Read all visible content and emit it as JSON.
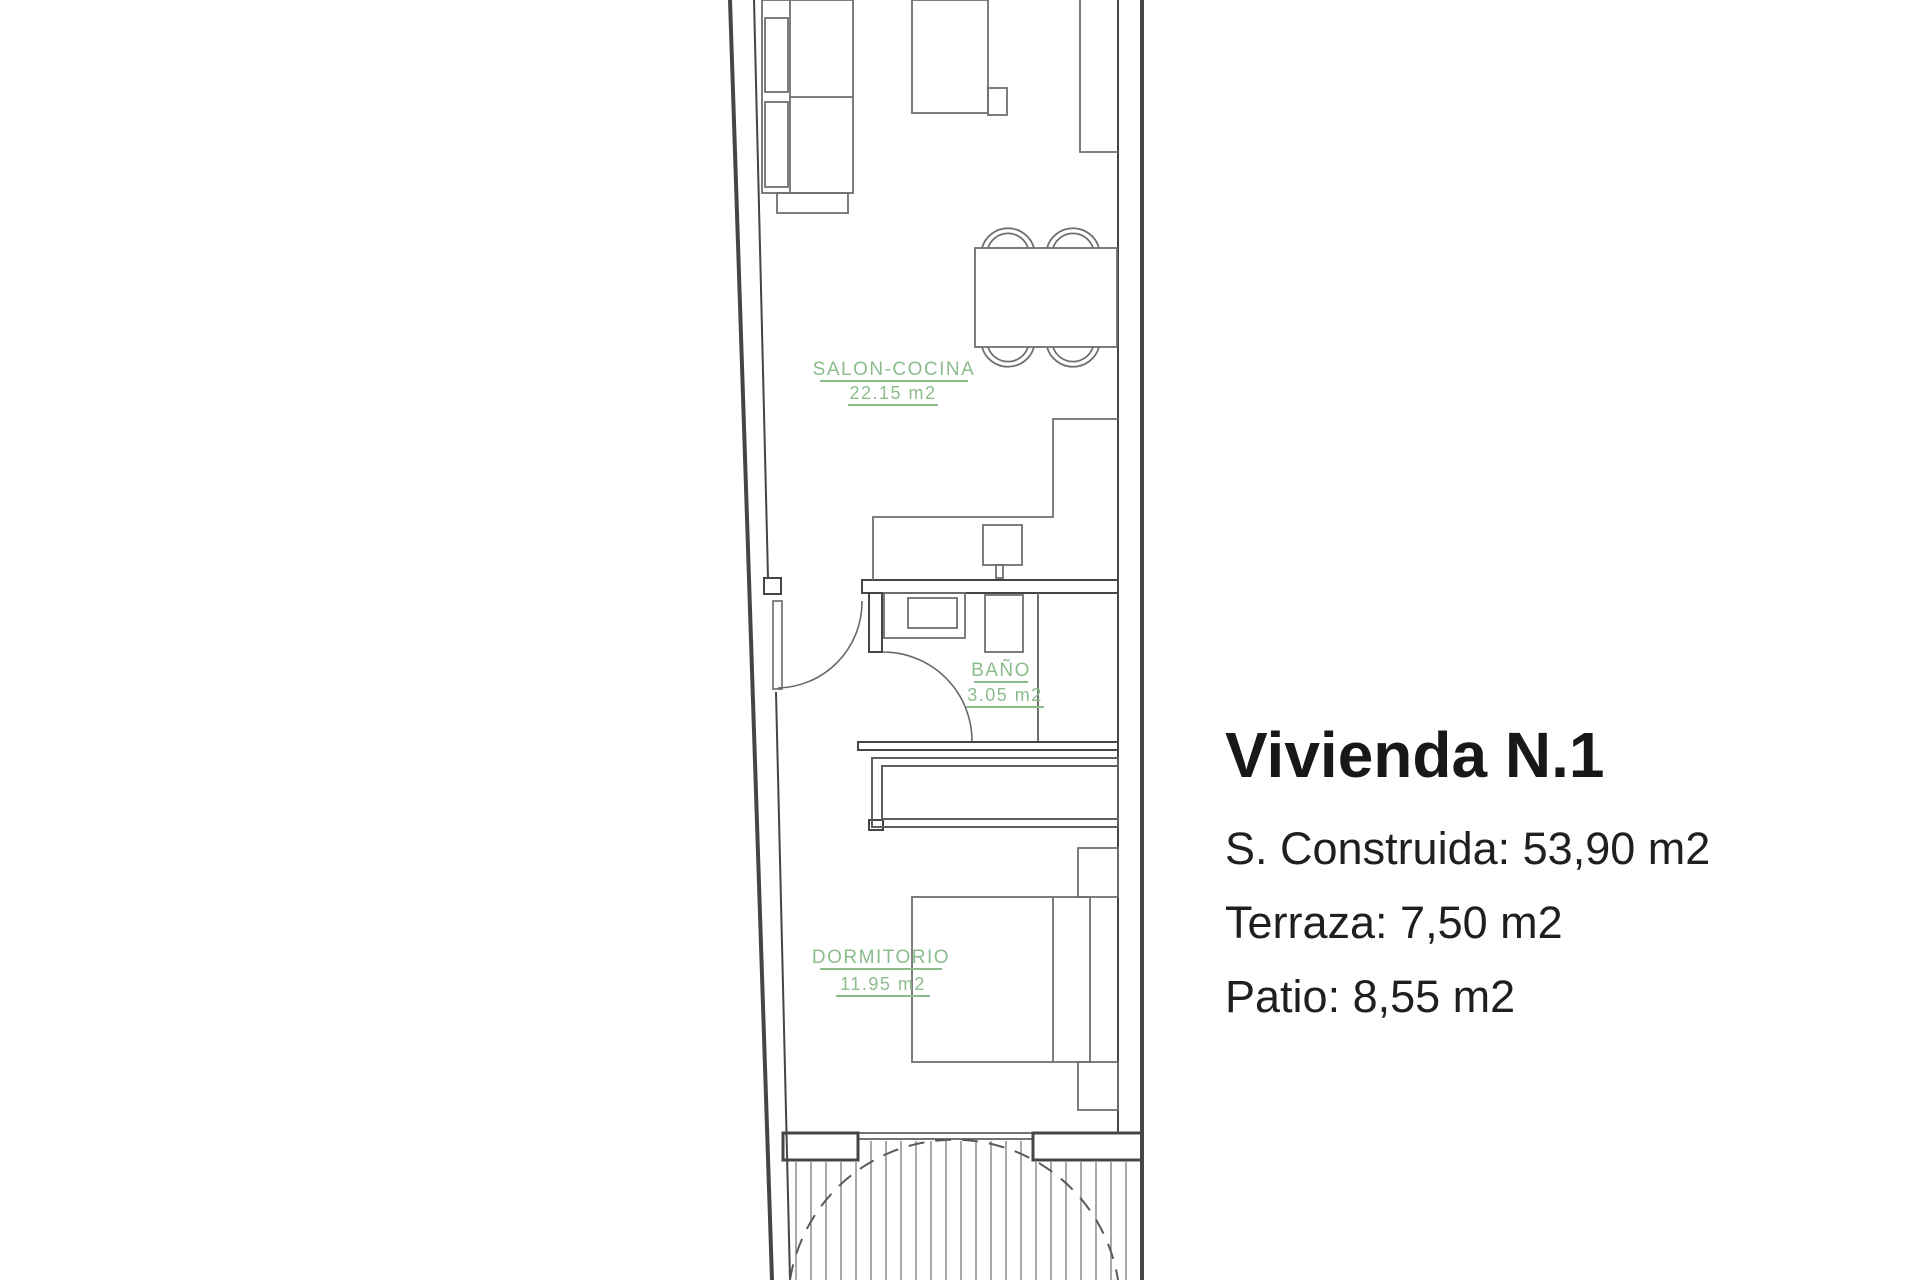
{
  "rooms": [
    {
      "name": "SALON-COCINA",
      "area": "22.15 m2"
    },
    {
      "name": "BAÑO",
      "area": "3.05 m2"
    },
    {
      "name": "DORMITORIO",
      "area": "11.95 m2"
    }
  ],
  "info_panel": {
    "title": "Vivienda N.1",
    "lines": [
      "S. Construida: 53,90 m2",
      "Terraza: 7,50 m2",
      "Patio: 8,55 m2"
    ]
  },
  "colors": {
    "label_green": "#8cbc8c",
    "wall_line": "#454545",
    "furniture_line": "#6f6f6f",
    "text_dark": "#1e1e1e"
  }
}
